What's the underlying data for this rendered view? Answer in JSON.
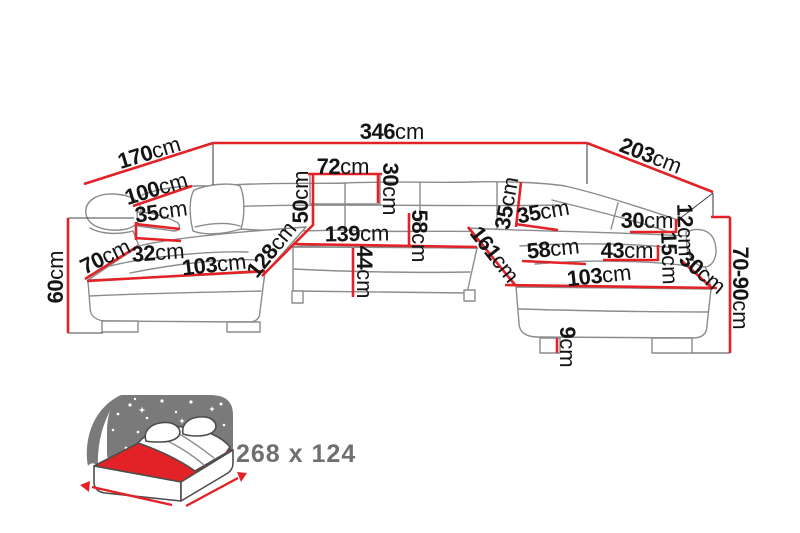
{
  "diagram": {
    "kind": "U-shaped corner sofa dimension drawing",
    "unit": "cm"
  },
  "dims": {
    "back_width": {
      "v": "346",
      "u": "cm"
    },
    "left_side": {
      "v": "170",
      "u": "cm"
    },
    "right_side": {
      "v": "203",
      "u": "cm"
    },
    "left_height": {
      "v": "60",
      "u": "cm"
    },
    "right_height": {
      "v": "70-90",
      "u": "cm"
    },
    "arm_length": {
      "v": "100",
      "u": "cm"
    },
    "arm_cushion": {
      "v": "35",
      "u": "cm"
    },
    "arm_width": {
      "v": "32",
      "u": "cm"
    },
    "chaise_end": {
      "v": "70",
      "u": "cm"
    },
    "chaise_front_left": {
      "v": "103",
      "u": "cm"
    },
    "chaise_length_left": {
      "v": "128",
      "u": "cm"
    },
    "backrest_height": {
      "v": "50",
      "u": "cm"
    },
    "headrest_width": {
      "v": "72",
      "u": "cm"
    },
    "headrest_height": {
      "v": "30",
      "u": "cm"
    },
    "middle_width": {
      "v": "139",
      "u": "cm"
    },
    "seat_depth": {
      "v": "58",
      "u": "cm"
    },
    "seat_height": {
      "v": "44",
      "u": "cm"
    },
    "back_right_height": {
      "v": "35",
      "u": "cm"
    },
    "corner_cushion": {
      "v": "35",
      "u": "cm"
    },
    "chaise_length_right": {
      "v": "161",
      "u": "cm"
    },
    "seat_right": {
      "v": "58",
      "u": "cm"
    },
    "backrest_right": {
      "v": "30",
      "u": "cm"
    },
    "gap_right": {
      "v": "12",
      "u": "cm"
    },
    "armrest_right": {
      "v": "43",
      "u": "cm"
    },
    "ledge_right": {
      "v": "15",
      "u": "cm"
    },
    "edge_right": {
      "v": "30",
      "u": "cm"
    },
    "chaise_front_right": {
      "v": "103",
      "u": "cm"
    },
    "leg_height": {
      "v": "9",
      "u": "cm"
    }
  },
  "bed": {
    "sleeping_area": "268 x 124"
  },
  "colors": {
    "dimension_red": "#e32227",
    "label_black": "#141414",
    "sofa_line_gray": "#8c8c8c",
    "bed_icon_gray": "#7a7a7a",
    "bed_mattress_red": "#e32227",
    "bed_text_gray": "#6f6f6f",
    "background": "#ffffff"
  }
}
